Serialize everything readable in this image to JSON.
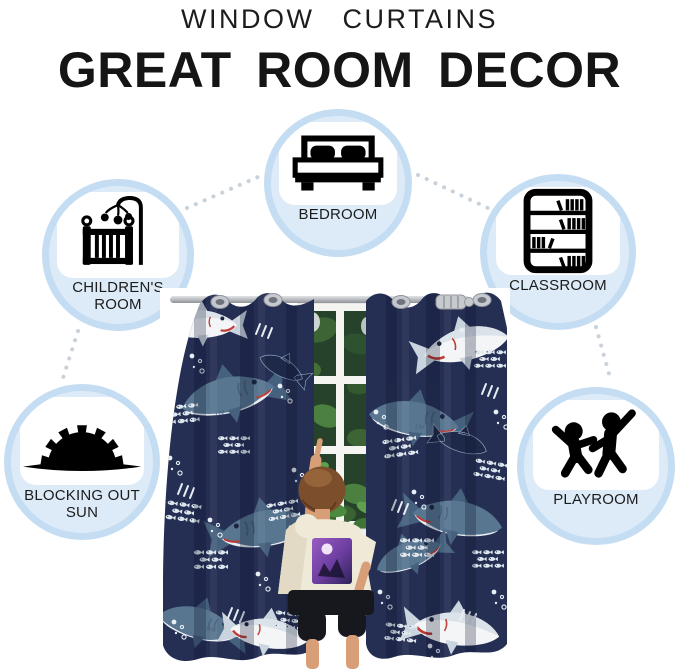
{
  "header": {
    "subtitle": "WINDOW CURTAINS",
    "title": "GREAT ROOM DECOR"
  },
  "features": [
    {
      "id": "bedroom",
      "label": "BEDROOM",
      "icon": "bed-icon"
    },
    {
      "id": "childrens-room",
      "label": "CHILDREN'S ROOM",
      "icon": "crib-icon"
    },
    {
      "id": "classroom",
      "label": "CLASSROOM",
      "icon": "bookshelf-icon"
    },
    {
      "id": "blocking-out-sun",
      "label": "BLOCKING OUT SUN",
      "icon": "sun-icon"
    },
    {
      "id": "playroom",
      "label": "PLAYROOM",
      "icon": "playing-children-icon"
    }
  ],
  "product": {
    "pattern_label": "LIV",
    "colors": {
      "curtain_navy": "#252f54",
      "shark_slate": "#597691",
      "shark_white": "#f3f5f7",
      "shark_dark": "#1e2949",
      "accent_red": "#bf3a33",
      "fish_white": "#dfe7ee",
      "circle_ring": "#c5ddf2",
      "circle_fill": "#ddebf8",
      "connector_dot": "#c9d2da",
      "foliage_green": "#4c8a3f",
      "rod_silver": "#c6c9cd"
    }
  }
}
